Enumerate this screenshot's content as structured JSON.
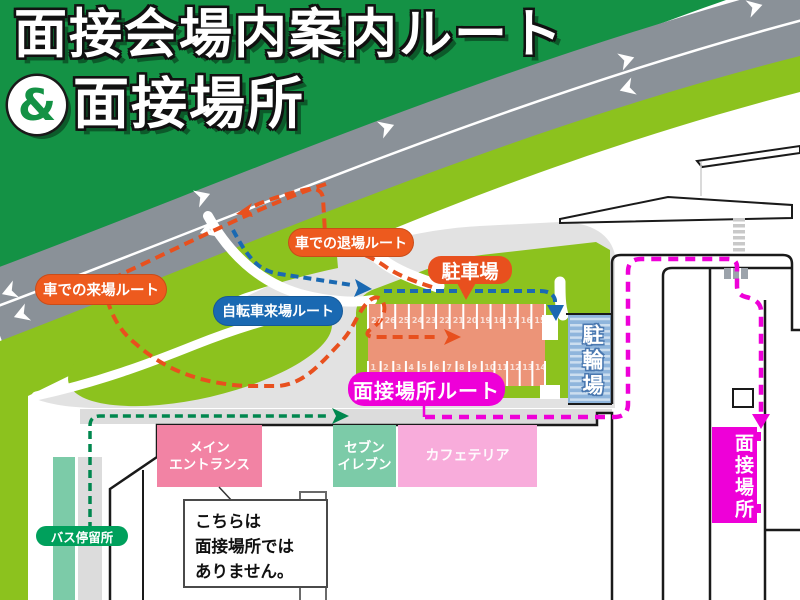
{
  "title": {
    "line1": "面接会場内案内ルート",
    "ampersand": "&",
    "line2": "面接場所"
  },
  "route_labels": {
    "car_arrival": "車での来場ルート",
    "car_exit": "車での退場ルート",
    "bicycle_arrival": "自転車来場ルート",
    "interview_route": "面接場所ルート"
  },
  "places": {
    "parking": "駐車場",
    "bicycle_parking": "駐輪場",
    "main_entrance_line1": "メイン",
    "main_entrance_line2": "エントランス",
    "seven_eleven_line1": "セブン",
    "seven_eleven_line2": "イレブン",
    "cafeteria": "カフェテリア",
    "interview_location": "面接場所",
    "bus_stop": "バス停留所"
  },
  "note": {
    "line1": "こちらは",
    "line2": "面接場所では",
    "line3": "ありません。"
  },
  "parking_stalls": {
    "top_row": [
      "27",
      "26",
      "25",
      "24",
      "23",
      "22",
      "21",
      "20",
      "19",
      "18",
      "17",
      "16",
      "15"
    ],
    "bottom_row": [
      "1",
      "2",
      "3",
      "4",
      "5",
      "6",
      "7",
      "8",
      "9",
      "10",
      "11",
      "12",
      "13",
      "14"
    ]
  },
  "colors": {
    "header_green": "#149245",
    "lawn_green": "#8CC21E",
    "road_gray": "#8A9198",
    "plaza_gray": "#E2E2E2",
    "route_orange": "#E8501E",
    "route_blue": "#1A69B2",
    "route_magenta": "#EE00D8",
    "route_dark_green": "#00874E",
    "parking_salmon": "#EC9478",
    "bike_blue": "#8FB5DC",
    "entrance_pink": "#F283A4",
    "seven_mint": "#7CCBA8",
    "cafeteria_pink": "#F8ACDB",
    "bus_green": "#00A05C"
  }
}
